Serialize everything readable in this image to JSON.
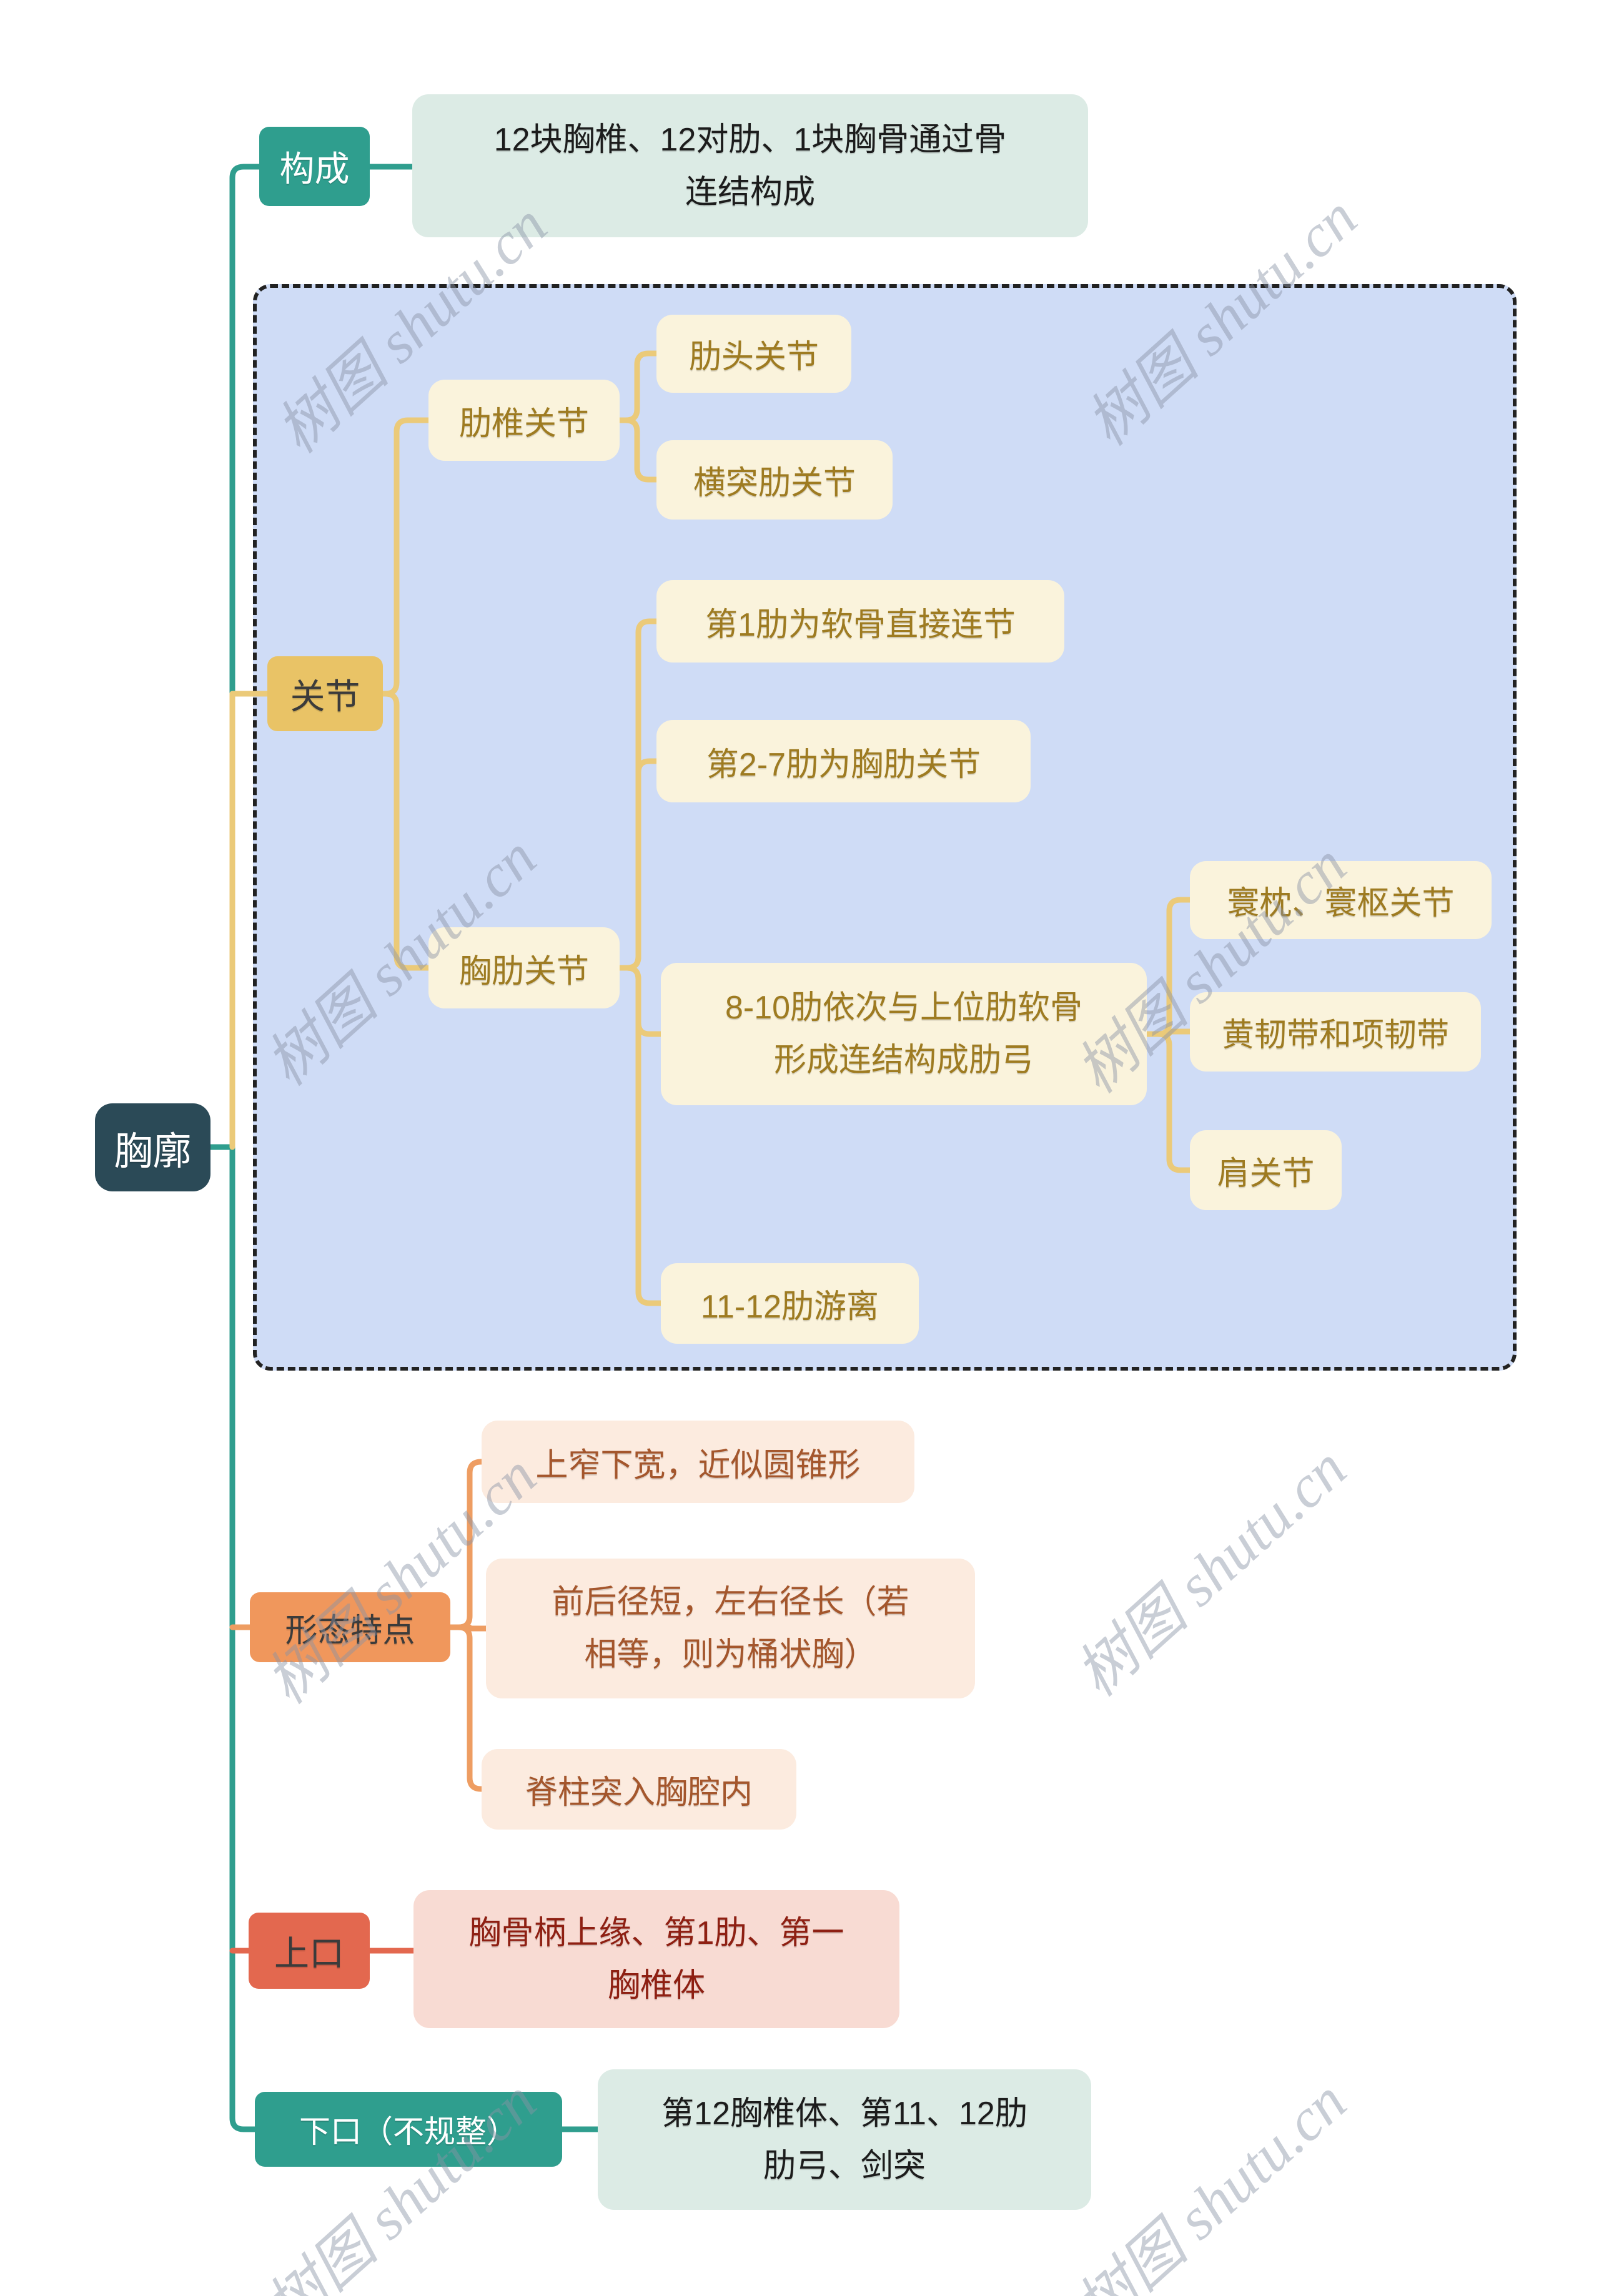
{
  "watermark": {
    "text": "树图 shutu.cn"
  },
  "colors": {
    "teal": "#2F9E8E",
    "root_bg": "#2B4A57",
    "yellow_node": "#E9C366",
    "yellow_line": "#EBCA79",
    "cream_box": "#FAF3DC",
    "gold_text": "#9E7B21",
    "container_bg": "#CFDCF6",
    "container_border": "#222222",
    "orange_node": "#F0975C",
    "orange_line": "#EE9D62",
    "peach_box": "#FCEBDF",
    "peach_text": "#A4562C",
    "red_node": "#E3684F",
    "pink_box": "#F8DBD3",
    "pink_text": "#8E1F12",
    "mint_box": "#DCEBE5",
    "dark_text": "#3B3B3B",
    "watermark": "#8A93A6"
  },
  "mindmap": {
    "root": "胸廓",
    "branches": [
      {
        "label": "构成",
        "children": [
          {
            "label": "12块胸椎、12对肋、1块胸骨通过骨\n连结构成"
          }
        ]
      },
      {
        "label": "关节",
        "children": [
          {
            "label": "肋椎关节",
            "children": [
              {
                "label": "肋头关节"
              },
              {
                "label": "横突肋关节"
              }
            ]
          },
          {
            "label": "胸肋关节",
            "children": [
              {
                "label": "第1肋为软骨直接连节"
              },
              {
                "label": "第2-7肋为胸肋关节"
              },
              {
                "label": "8-10肋依次与上位肋软骨\n形成连结构成肋弓",
                "children": [
                  {
                    "label": "寰枕、寰枢关节"
                  },
                  {
                    "label": "黄韧带和项韧带"
                  },
                  {
                    "label": "肩关节"
                  }
                ]
              },
              {
                "label": "11-12肋游离"
              }
            ]
          }
        ]
      },
      {
        "label": "形态特点",
        "children": [
          {
            "label": "上窄下宽，近似圆锥形"
          },
          {
            "label": "前后径短，左右径长（若\n相等，则为桶状胸）"
          },
          {
            "label": "脊柱突入胸腔内"
          }
        ]
      },
      {
        "label": "上口",
        "children": [
          {
            "label": "胸骨柄上缘、第1肋、第一\n胸椎体"
          }
        ]
      },
      {
        "label": "下口（不规整）",
        "children": [
          {
            "label": "第12胸椎体、第11、12肋\n肋弓、剑突"
          }
        ]
      }
    ]
  }
}
